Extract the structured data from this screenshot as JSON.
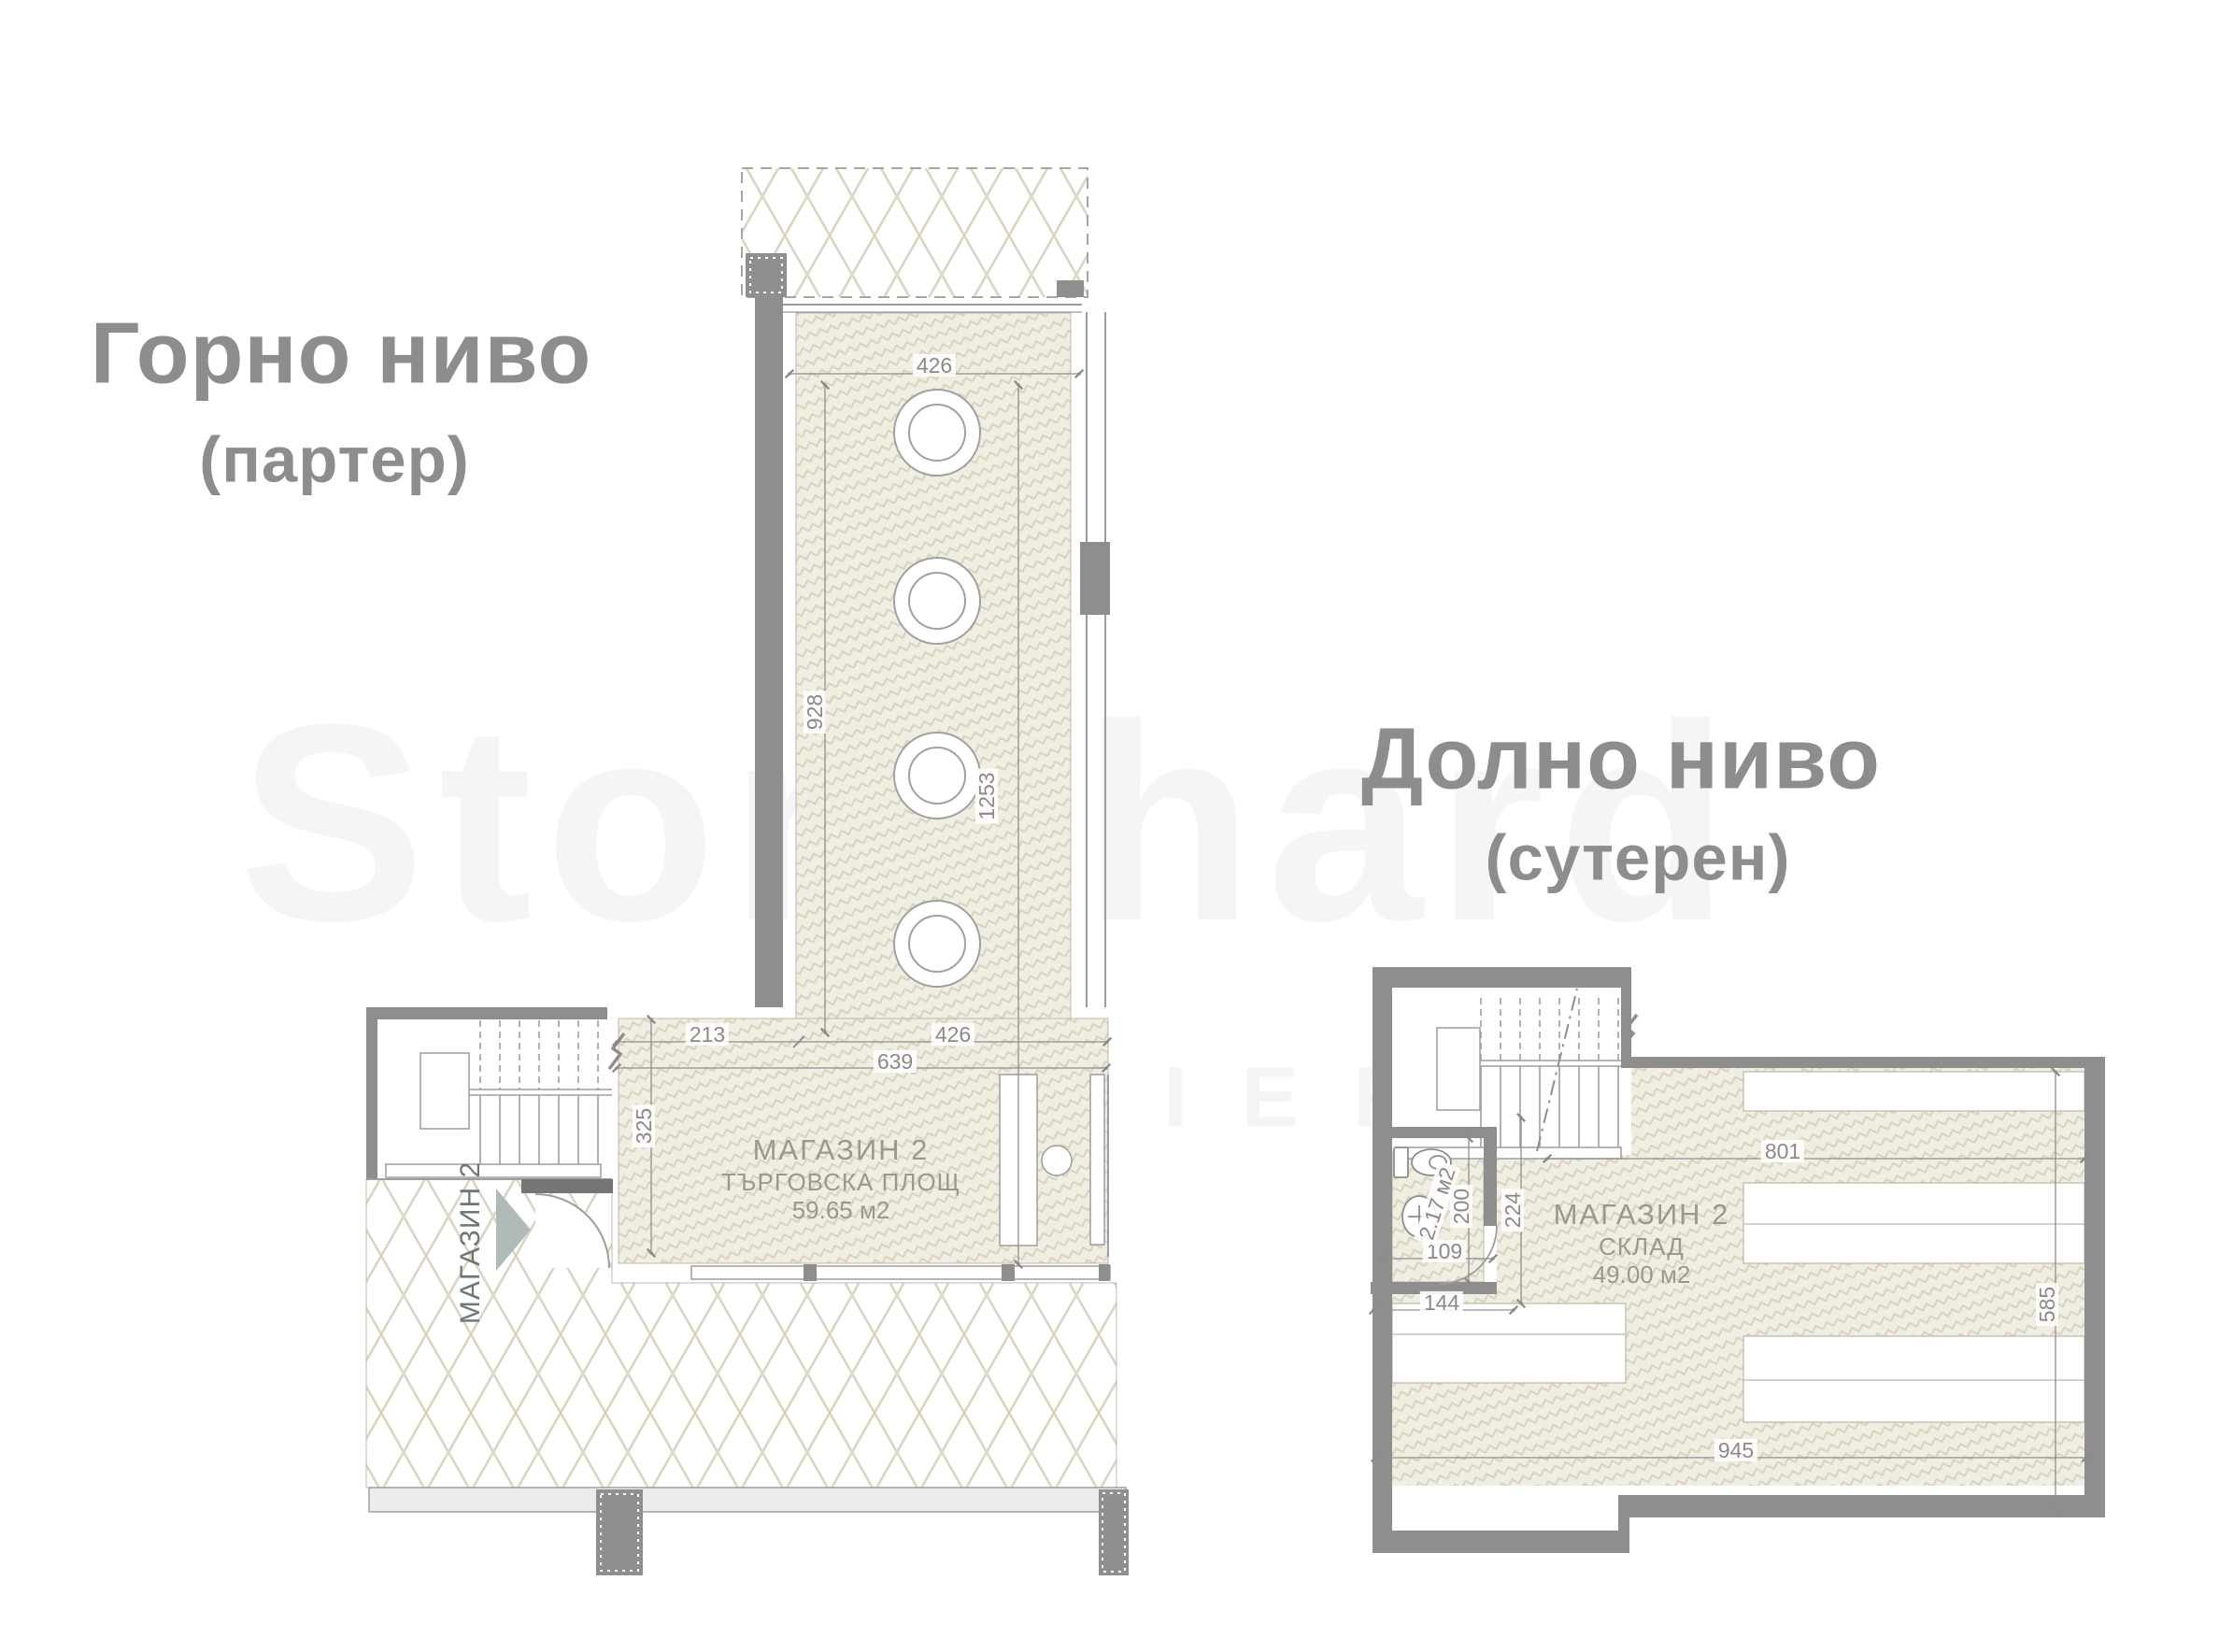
{
  "upper_level": {
    "title": "Горно ниво",
    "subtitle": "(партер)",
    "room_name": "МАГАЗИН 2",
    "room_type": "ТЪРГОВСКА ПЛОЩ",
    "room_area": "59.65 м2",
    "entry_label": "МАГАЗИН 2",
    "dim_top_width": "426",
    "dim_upper_height": "928",
    "dim_total_height": "1253",
    "dim_stair_span": "213",
    "dim_lower_width": "426",
    "dim_inner_width": "639",
    "dim_entry_depth": "325"
  },
  "lower_level": {
    "title": "Долно ниво",
    "subtitle": "(сутерен)",
    "room_name": "МАГАЗИН 2",
    "room_type": "СКЛАД",
    "room_area": "49.00 м2",
    "wc_area": "2.17 м2",
    "dim_top_width": "801",
    "dim_right_height": "585",
    "dim_bottom_width": "945",
    "dim_stair_depth": "224",
    "dim_wc_height": "200",
    "dim_wc_width": "109",
    "dim_shelf_width": "144"
  },
  "watermark": {
    "line1": "Stonchard",
    "line2": "PREMIER"
  },
  "colors": {
    "wall": "#8e8e8e",
    "thin_line": "#9e9e9e",
    "hatch_line": "#d8d3bf",
    "hatch_bg": "#f0ede2",
    "dim_text": "#8a8a8a",
    "title_text": "#8c8d8e",
    "arrow": "#b0bab8",
    "band_fill": "#ececec"
  }
}
